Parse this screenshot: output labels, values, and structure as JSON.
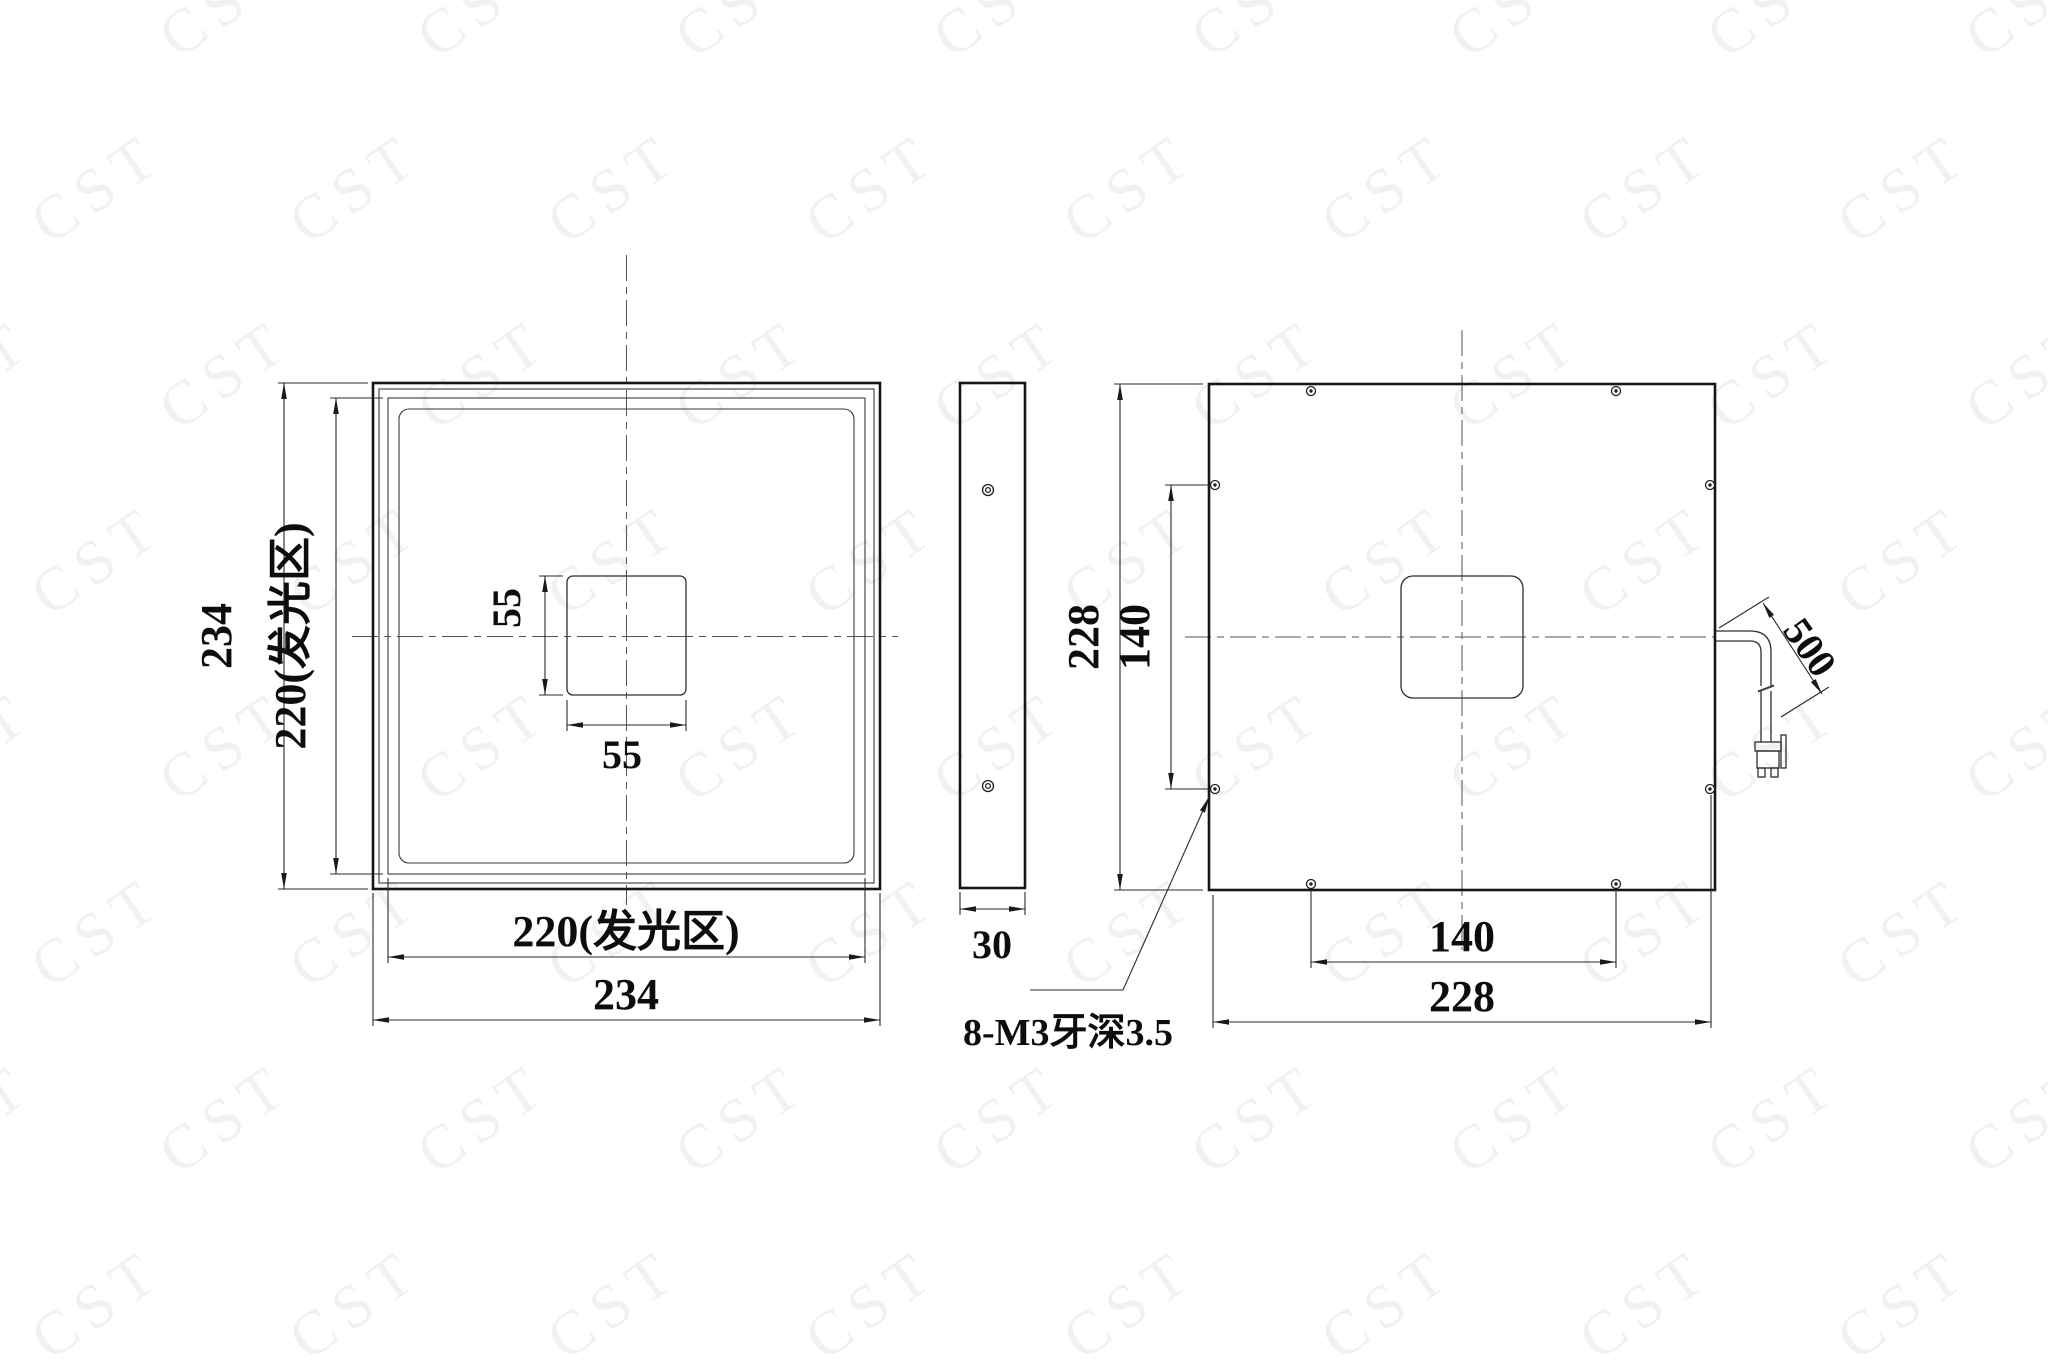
{
  "drawing": {
    "watermark": "CST",
    "line_color": "#161616",
    "watermark_color": "#f1f1f1",
    "views": {
      "front": {
        "label_height_outer": "234",
        "label_height_luminous": "220(发光区)",
        "label_square_v": "55",
        "label_square_h": "55",
        "label_width_luminous": "220(发光区)",
        "label_width_outer": "234"
      },
      "side": {
        "label_thickness": "30"
      },
      "back": {
        "label_height": "228",
        "label_holes_v": "140",
        "label_holes_h": "140",
        "label_width": "228",
        "label_cable_length": "500",
        "label_thread_note": "8-M3牙深3.5"
      }
    }
  }
}
